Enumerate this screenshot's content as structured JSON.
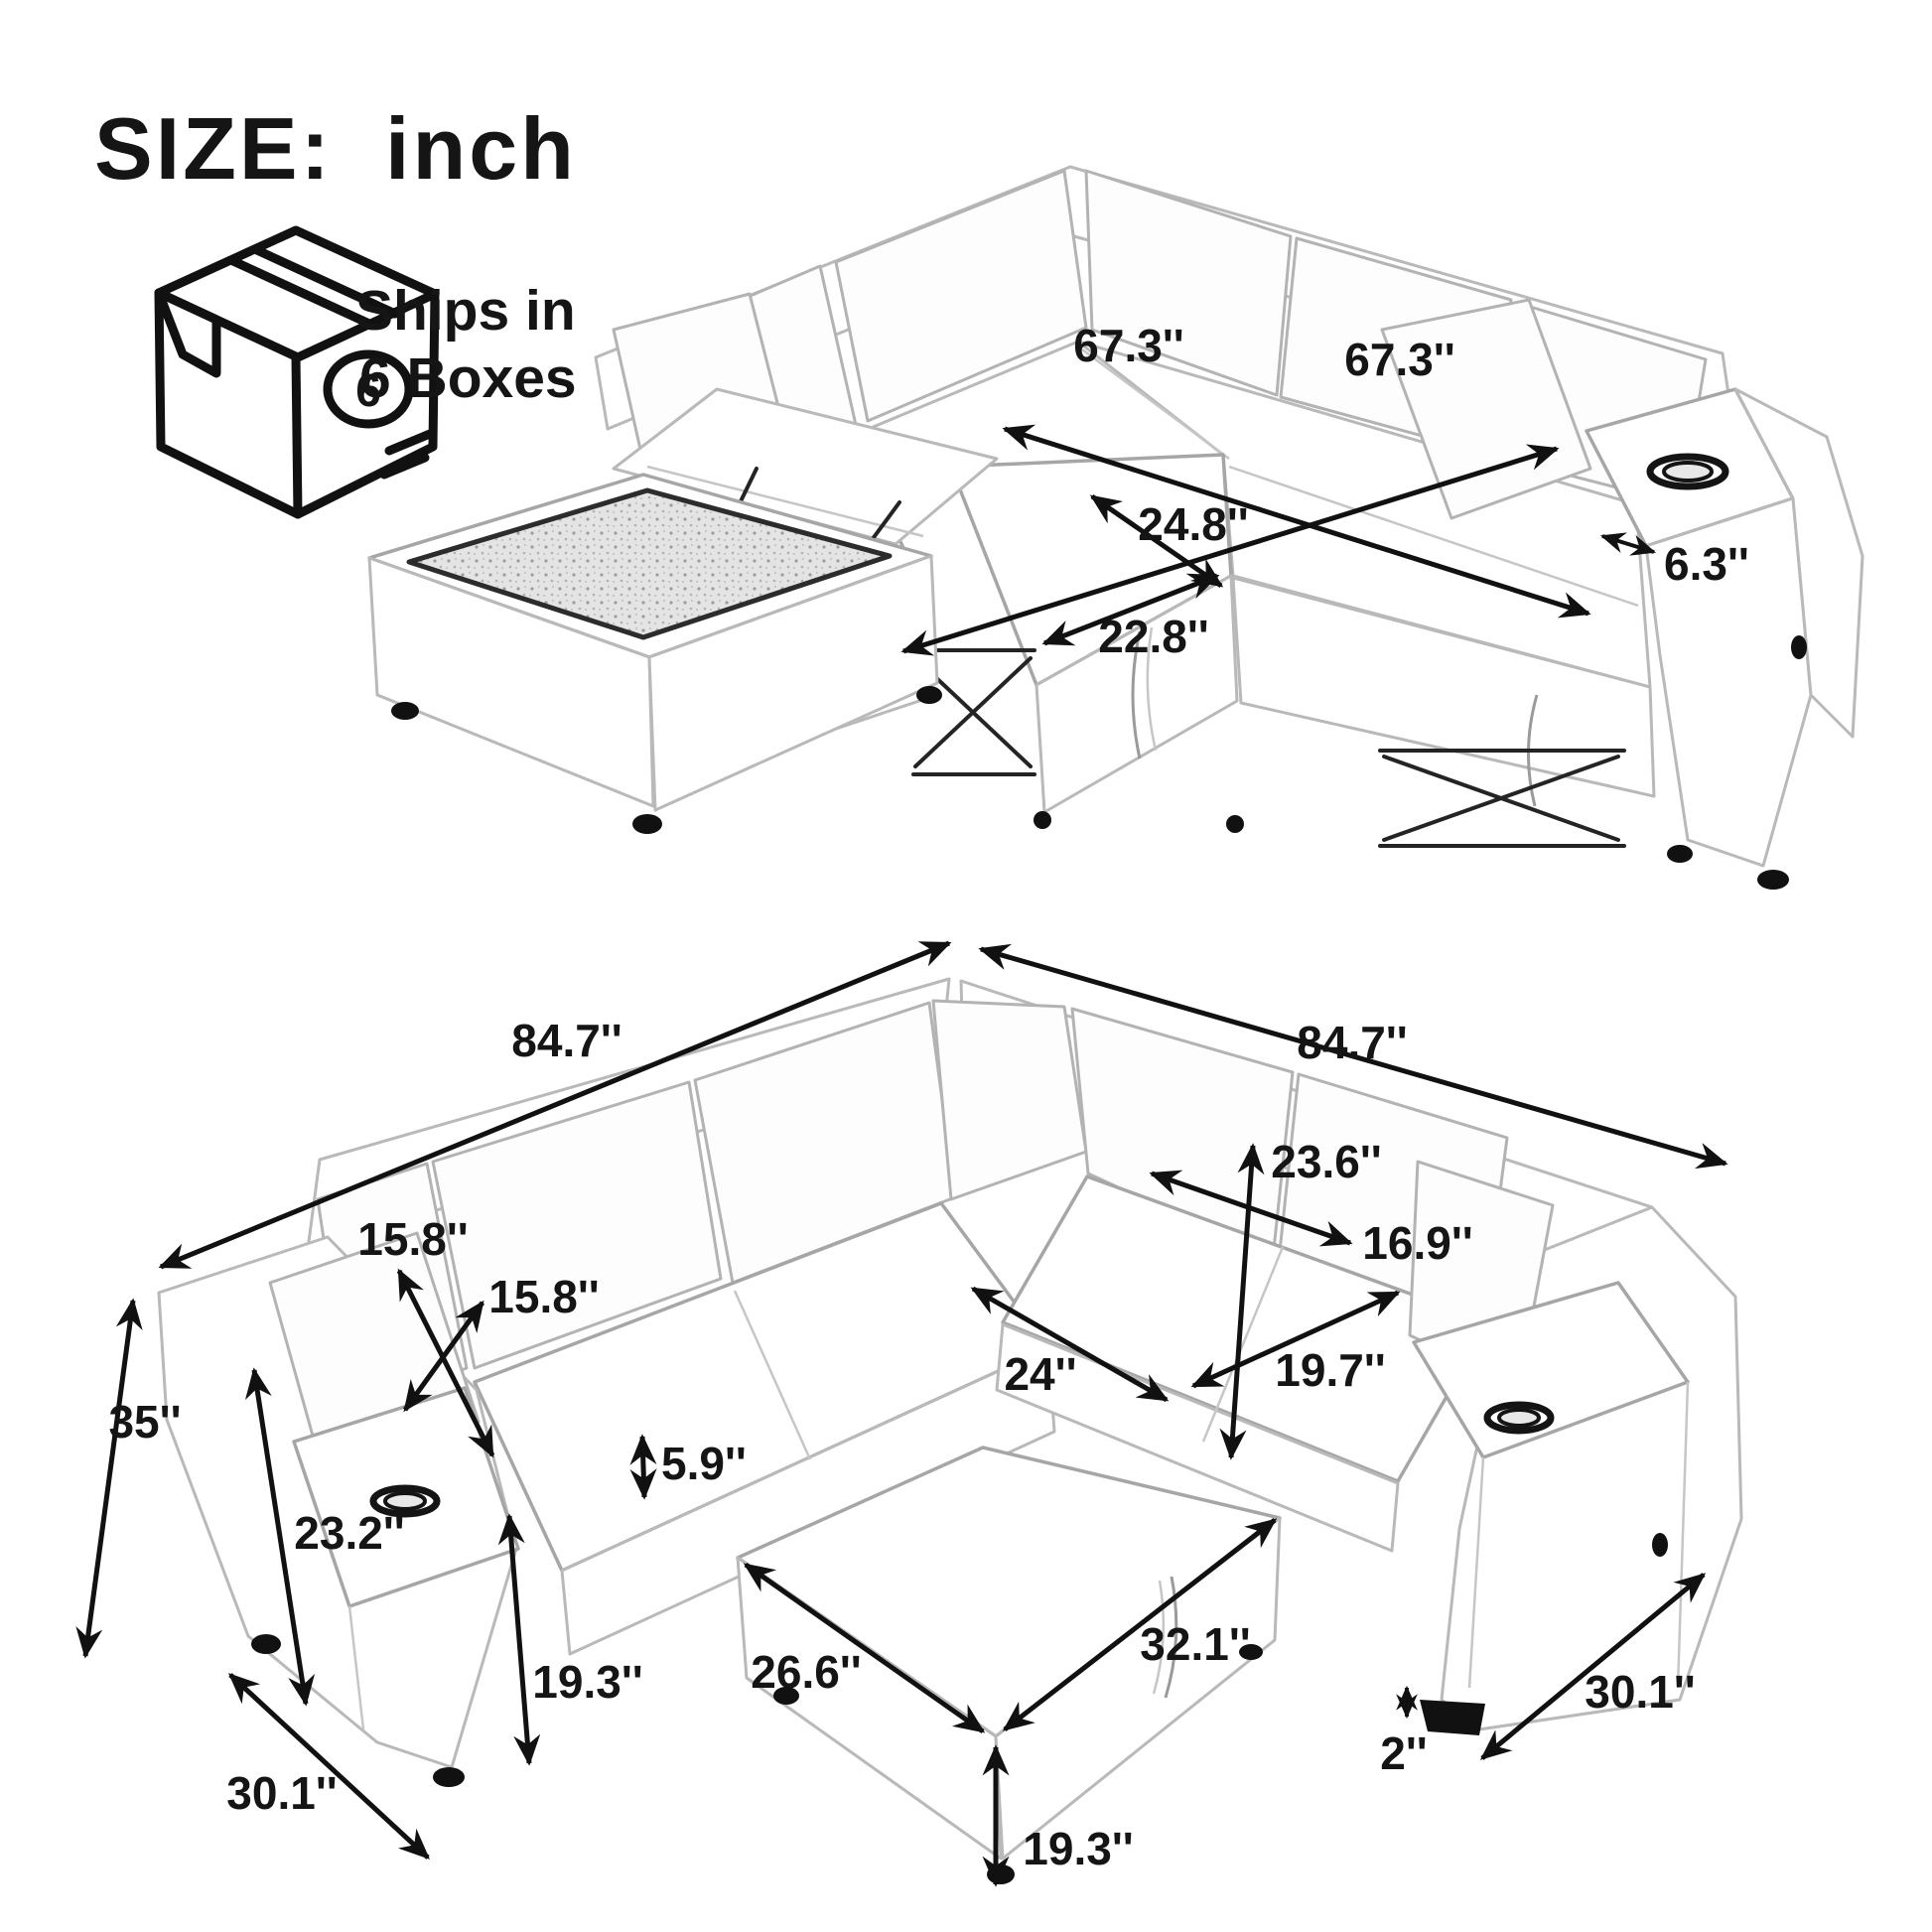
{
  "header": {
    "size_label": "SIZE:",
    "unit_label": "inch"
  },
  "shipping": {
    "line1": "Ships in",
    "line2": "6 Boxes",
    "box_count": "6"
  },
  "colors": {
    "ink": "#111111",
    "sketch": "#b3b3b3",
    "texture_fill": "#e4e4e4"
  },
  "top_view": {
    "name": "sectional-sleeper-pulled-out",
    "dimensions": {
      "bed_length_left": "67.3''",
      "bed_length_right": "67.3''",
      "pullout_depth": "24.8''",
      "pullout_width": "22.8''",
      "armrest_width": "6.3''"
    }
  },
  "bottom_view": {
    "name": "sectional-sofa-with-storage-ottoman",
    "dimensions": {
      "overall_width_left": "84.7''",
      "overall_width_right": "84.7''",
      "overall_height": "35''",
      "arm_height": "23.2''",
      "back_cushion_width": "15.8''",
      "back_cushion_height": "15.8''",
      "right_back_cushion_height": "23.6''",
      "right_back_cushion_width": "16.9''",
      "seat_width": "24''",
      "seat_depth": "19.7''",
      "seat_cushion_thickness": "5.9''",
      "seat_height": "19.3''",
      "base_depth_left": "30.1''",
      "base_depth_right": "30.1''",
      "leg_height": "2''",
      "ottoman_width": "26.6''",
      "ottoman_length": "32.1''",
      "ottoman_height": "19.3''"
    }
  }
}
